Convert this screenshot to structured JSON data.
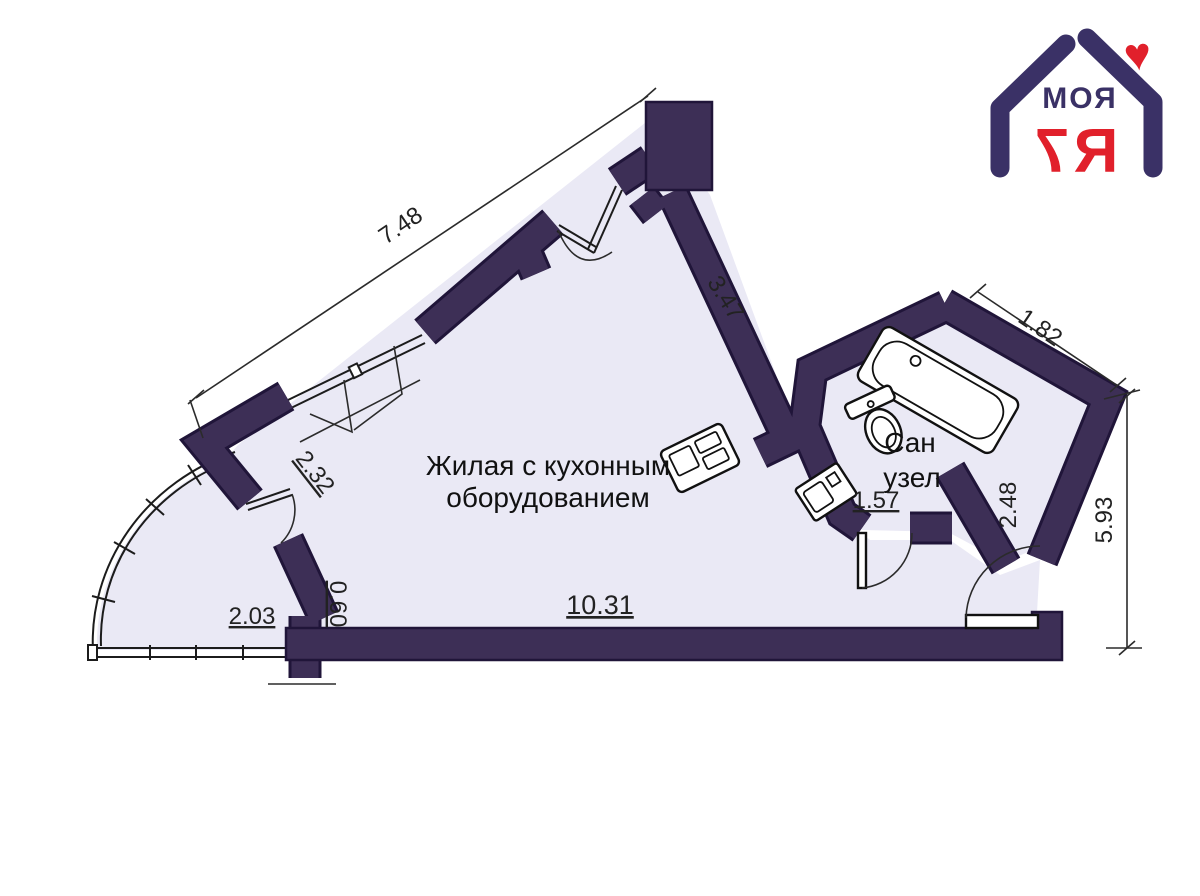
{
  "header": {
    "logo": {
      "word": "МОЯ",
      "digit": "7",
      "letter": "Я",
      "heart_symbol": "♥"
    }
  },
  "plan": {
    "room_labels": {
      "living_line1": "Жилая с кухонным",
      "living_line2": "оборудованием",
      "bath_line1": "Сан",
      "bath_line2": "узел"
    },
    "dimensions": {
      "top_wall": "7.48",
      "right_upper_wall": "3.47",
      "bath_outer": "1.82",
      "right_side": "5.93",
      "hall_nook": "2.48",
      "bath_area": "1.57",
      "balcony_opening": "2.32",
      "wall_stub": "0.60",
      "balcony_width": "2.03",
      "bottom_wall": "10.31"
    },
    "colors": {
      "wall_fill": "#3d2f56",
      "wall_outline": "#201539",
      "floor_fill": "#eae9f5",
      "dimension_text": "#222222",
      "logo_navy": "#3a3166",
      "logo_red": "#e1202b"
    }
  }
}
